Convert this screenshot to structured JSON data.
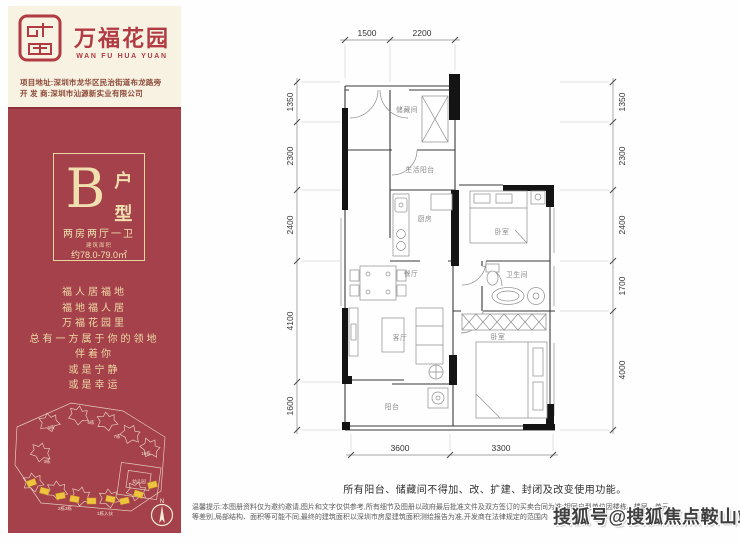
{
  "brand": {
    "name_cn": "万福花园",
    "name_en": "WAN FU HUA YUAN",
    "address": "项目地址:深圳市龙华区民治街道布龙路旁",
    "developer": "开 发 商:深圳市汕源新实业有限公司"
  },
  "unit": {
    "letter": "B",
    "type_char_1": "户",
    "type_char_2": "型",
    "rooms_desc": "两房两厅一卫",
    "area_caption": "建筑面积",
    "area_value": "约78.0-79.0㎡"
  },
  "slogan": [
    "福人居福地",
    "福地福人居",
    "万福花园里",
    "总有一方属于你的领地",
    "伴着你",
    "或是宁静",
    "或是幸运"
  ],
  "site_map": {
    "labels": [
      "5栋",
      "6栋",
      "7栋",
      "10栋",
      "3栋",
      "幼儿园",
      "2栋3栋",
      "1栋入伙"
    ],
    "north": "N",
    "highlight_color": "#eec43e"
  },
  "floor_plan": {
    "rooms": {
      "storage": "储藏间",
      "life_balcony": "生活阳台",
      "kitchen": "厨房",
      "dining": "餐厅",
      "bedroom1": "卧室",
      "bathroom": "卫生间",
      "living": "客厅",
      "bedroom2": "卧室",
      "balcony": "阳台"
    },
    "dims": {
      "top": [
        "1500",
        "2200"
      ],
      "left": [
        "1350",
        "2300",
        "2400",
        "4100",
        "1600"
      ],
      "right": [
        "1350",
        "2300",
        "2400",
        "1700",
        "4000"
      ],
      "bottom": [
        "3600",
        "3300"
      ]
    },
    "note": "所有阳台、储藏间不得加、改、扩建、封闭及改变使用功能。"
  },
  "disclaimer": {
    "line1": "温馨提示:本图册资料仅为邀约邀请,图片和文字仅供参考,所有细节及图册以政府最后批准文件及双方签订的买卖合同为准;相同户型单位因楼栋、楼层、单元",
    "line2": "等差别,局部结构、面积等可能不同,最终的建筑面积以深圳市房屋建筑面积测绘报告为准,开发商在法律规定的范围内"
  },
  "watermark": {
    "text": "搜狐号@搜狐焦点鞍山站"
  },
  "colors": {
    "panel_red": "#a5414b",
    "brand_red": "#b13a43",
    "cream_bg": "#f8f2e3",
    "gold_text": "#eed9a6",
    "highlight_yellow": "#eec43e"
  }
}
